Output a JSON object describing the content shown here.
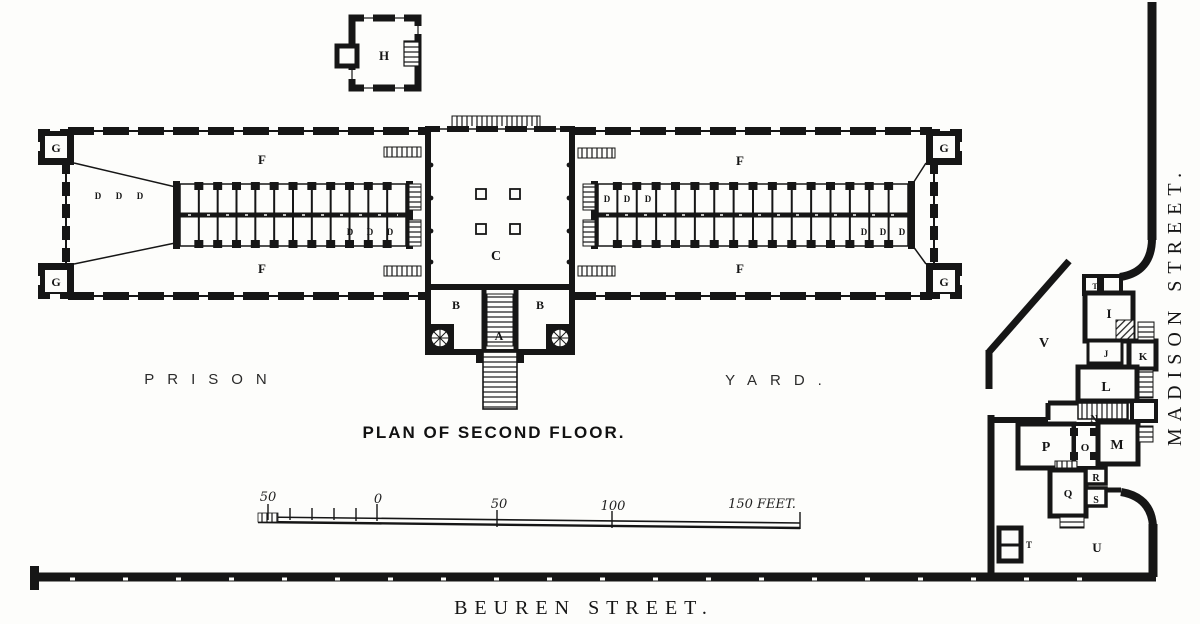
{
  "palette": {
    "paper": "#fdfdfb",
    "ink": "#161616"
  },
  "texts": {
    "plan_title": "PLAN OF SECOND FLOOR.",
    "yard_left": "PRISON",
    "yard_right": "YARD.",
    "street_bottom": "BEUREN STREET.",
    "street_right": "MADISON STREET.",
    "scale": [
      "50",
      "0",
      "50",
      "100",
      "150 FEET."
    ]
  },
  "plan": {
    "room_labels": [
      {
        "t": "H",
        "x": 384,
        "y": 60,
        "s": 13
      },
      {
        "t": "G",
        "x": 56,
        "y": 152,
        "s": 12
      },
      {
        "t": "G",
        "x": 56,
        "y": 286,
        "s": 12
      },
      {
        "t": "G",
        "x": 944,
        "y": 152,
        "s": 12
      },
      {
        "t": "G",
        "x": 944,
        "y": 286,
        "s": 12
      },
      {
        "t": "F",
        "x": 262,
        "y": 164,
        "s": 13
      },
      {
        "t": "F",
        "x": 740,
        "y": 165,
        "s": 13
      },
      {
        "t": "F",
        "x": 262,
        "y": 273,
        "s": 13
      },
      {
        "t": "F",
        "x": 740,
        "y": 273,
        "s": 13
      },
      {
        "t": "D",
        "x": 98,
        "y": 199,
        "s": 9
      },
      {
        "t": "D",
        "x": 119,
        "y": 199,
        "s": 9
      },
      {
        "t": "D",
        "x": 140,
        "y": 199,
        "s": 9
      },
      {
        "t": "D",
        "x": 350,
        "y": 235,
        "s": 9
      },
      {
        "t": "D",
        "x": 370,
        "y": 235,
        "s": 9
      },
      {
        "t": "D",
        "x": 390,
        "y": 235,
        "s": 9
      },
      {
        "t": "D",
        "x": 607,
        "y": 202,
        "s": 9
      },
      {
        "t": "D",
        "x": 627,
        "y": 202,
        "s": 9
      },
      {
        "t": "D",
        "x": 648,
        "y": 202,
        "s": 9
      },
      {
        "t": "D",
        "x": 864,
        "y": 235,
        "s": 9
      },
      {
        "t": "D",
        "x": 883,
        "y": 235,
        "s": 9
      },
      {
        "t": "D",
        "x": 902,
        "y": 235,
        "s": 9
      },
      {
        "t": "C",
        "x": 496,
        "y": 260,
        "s": 14
      },
      {
        "t": "B",
        "x": 456,
        "y": 309,
        "s": 12
      },
      {
        "t": "B",
        "x": 540,
        "y": 309,
        "s": 12
      },
      {
        "t": "A",
        "x": 499,
        "y": 340,
        "s": 12
      },
      {
        "t": "V",
        "x": 1044,
        "y": 347,
        "s": 14
      },
      {
        "t": "I",
        "x": 1109,
        "y": 318,
        "s": 13
      },
      {
        "t": "J",
        "x": 1106,
        "y": 357,
        "s": 9
      },
      {
        "t": "K",
        "x": 1143,
        "y": 360,
        "s": 11
      },
      {
        "t": "L",
        "x": 1106,
        "y": 391,
        "s": 14
      },
      {
        "t": "N",
        "x": 1094,
        "y": 422,
        "s": 10
      },
      {
        "t": "P",
        "x": 1046,
        "y": 451,
        "s": 14
      },
      {
        "t": "O",
        "x": 1085,
        "y": 451,
        "s": 11
      },
      {
        "t": "M",
        "x": 1117,
        "y": 449,
        "s": 14
      },
      {
        "t": "R",
        "x": 1096,
        "y": 481,
        "s": 10
      },
      {
        "t": "S",
        "x": 1096,
        "y": 503,
        "s": 10
      },
      {
        "t": "Q",
        "x": 1068,
        "y": 497,
        "s": 11
      },
      {
        "t": "T",
        "x": 1095,
        "y": 289,
        "s": 8
      },
      {
        "t": "T",
        "x": 1029,
        "y": 548,
        "s": 9
      },
      {
        "t": "U",
        "x": 1097,
        "y": 552,
        "s": 13
      }
    ],
    "cell_blocks": [
      {
        "id": "cells-left",
        "x1": 180,
        "x2": 406,
        "y": 184,
        "h": 62,
        "n": 12
      },
      {
        "id": "cells-right",
        "x1": 598,
        "x2": 908,
        "y": 184,
        "h": 62,
        "n": 16
      }
    ]
  }
}
